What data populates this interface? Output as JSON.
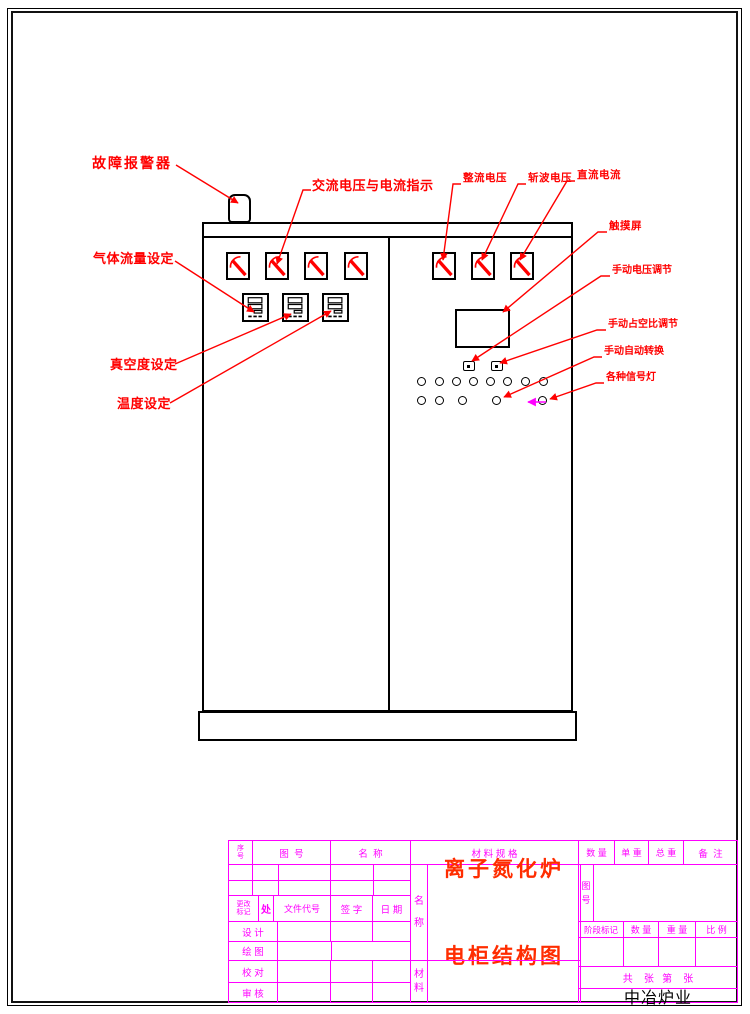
{
  "colors": {
    "annotation_red": "#ff0000",
    "titleblock_magenta": "#ff00ff",
    "title_text_red": "#ff2d00",
    "drawing_black": "#000000",
    "pointer_magenta": "#ff00ff"
  },
  "annotations": {
    "alarm": "故障报警器",
    "ac_meters": "交流电压与电流指示",
    "gas_flow": "气体流量设定",
    "vacuum": "真空度设定",
    "temperature": "温度设定",
    "rectifier_voltage": "整流电压",
    "chopper_voltage": "斩波电压",
    "dc_current": "直流电流",
    "touch_screen": "触摸屏",
    "manual_voltage": "手动电压调节",
    "manual_duty": "手动占空比调节",
    "manual_auto_switch": "手动自动转换",
    "signal_lights": "各种信号灯"
  },
  "title_block": {
    "bom_header": [
      "序号",
      "图  号",
      "名  称",
      "材 料 规 格",
      "数 量",
      "单 重",
      "总 重",
      "备  注"
    ],
    "change_row": {
      "mark": "更改标记",
      "count": "处",
      "doc_code": "文件代号",
      "sign": "签 字",
      "date": "日 期"
    },
    "roles": [
      "设 计",
      "绘 图",
      "校 对",
      "审 核"
    ],
    "name_label": "名称",
    "material_label": "材料",
    "drawing_no_label": "图号",
    "stage_header": [
      "阶段标记",
      "数 量",
      "重 量",
      "比 例"
    ],
    "sheet_info": "共    张   第    张",
    "drawing_title": {
      "line1": "离子氮化炉",
      "line2": "电柜结构图"
    },
    "company": "中冶炉业"
  }
}
